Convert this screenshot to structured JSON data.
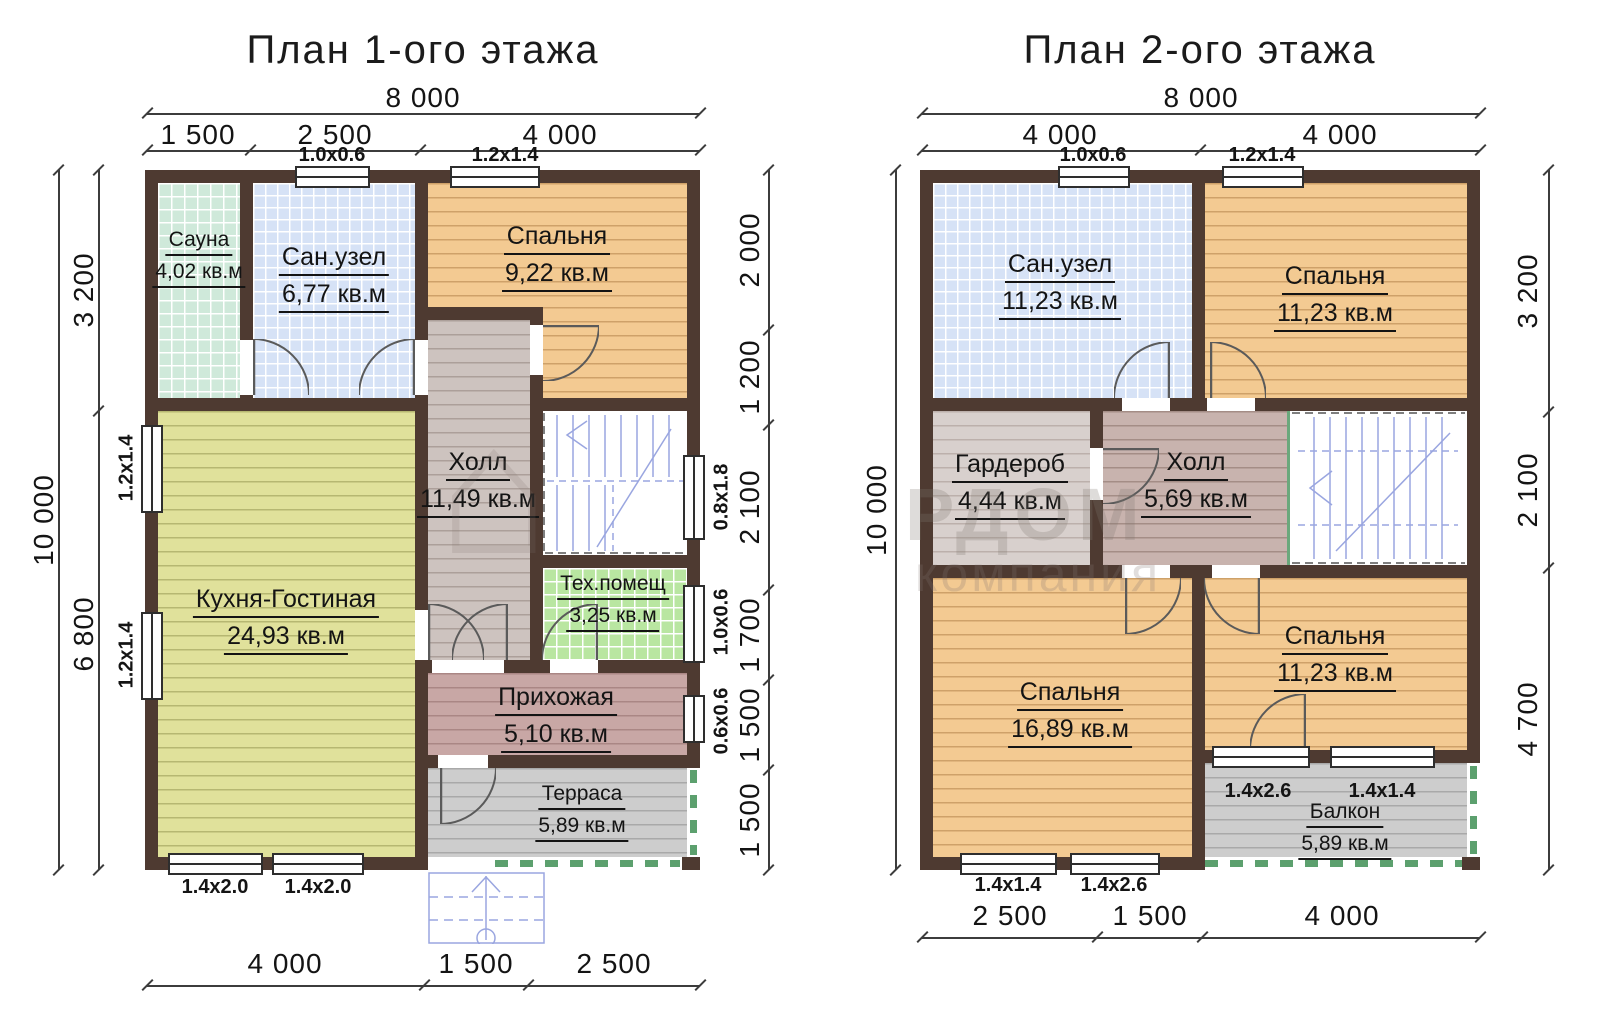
{
  "watermark": {
    "icon": "house-logo",
    "brand": "РДОМ",
    "subtitle": "компания"
  },
  "plans": [
    {
      "title": "План 1-ого этажа",
      "dims": {
        "top_total": "8 000",
        "top": [
          "1 500",
          "2 500",
          "4 000"
        ],
        "left_total": "10 000",
        "left": [
          "3 200",
          "6 800"
        ],
        "right": [
          "2 000",
          "1 200",
          "2 100",
          "1 700",
          "1 500",
          "1 500"
        ],
        "bottom": [
          "4 000",
          "1 500",
          "2 500"
        ]
      },
      "windows": {
        "top": [
          "1.0x0.6",
          "1.2x1.4"
        ],
        "left": [
          "1.2x1.4",
          "1.2x1.4"
        ],
        "right": [
          "0.8x1.8",
          "1.0x0.6",
          "0.6x0.6"
        ],
        "bottom": [
          "1.4x2.0",
          "1.4x2.0"
        ]
      },
      "rooms": [
        {
          "name": "Сауна",
          "area": "4,02 кв.м"
        },
        {
          "name": "Сан.узел",
          "area": "6,77 кв.м"
        },
        {
          "name": "Спальня",
          "area": "9,22 кв.м"
        },
        {
          "name": "Холл",
          "area": "11,49 кв.м"
        },
        {
          "name": "Кухня-Гостиная",
          "area": "24,93 кв.м"
        },
        {
          "name": "Тех.помещ",
          "area": "3,25 кв.м"
        },
        {
          "name": "Прихожая",
          "area": "5,10 кв.м"
        },
        {
          "name": "Терраса",
          "area": "5,89 кв.м"
        }
      ]
    },
    {
      "title": "План 2-ого этажа",
      "dims": {
        "top_total": "8 000",
        "top": [
          "4 000",
          "4 000"
        ],
        "left_total": "10 000",
        "right": [
          "3 200",
          "2 100",
          "4 700"
        ],
        "bottom": [
          "2 500",
          "1 500",
          "4 000"
        ]
      },
      "windows": {
        "top": [
          "1.0x0.6",
          "1.2x1.4"
        ],
        "balcony": [
          "1.4x2.6",
          "1.4x1.4"
        ],
        "bottom": [
          "1.4x1.4",
          "1.4x2.6"
        ]
      },
      "rooms": [
        {
          "name": "Сан.узел",
          "area": "11,23 кв.м"
        },
        {
          "name": "Спальня",
          "area": "11,23 кв.м"
        },
        {
          "name": "Гардероб",
          "area": "4,44 кв.м"
        },
        {
          "name": "Холл",
          "area": "5,69 кв.м"
        },
        {
          "name": "Спальня",
          "area": "16,89 кв.м"
        },
        {
          "name": "Спальня",
          "area": "11,23 кв.м"
        },
        {
          "name": "Балкон",
          "area": "5,89 кв.м"
        }
      ]
    }
  ],
  "colors": {
    "wall": "#4e3a31",
    "sauna_tile": "#cfe9da",
    "bath_tile": "#d6e2f6",
    "bedroom_floor": "#f3ca92",
    "kitchen_floor": "#e0e19b",
    "hall_floor": "#cdc3bf",
    "tech_tile": "#b9e6a1",
    "hallway_floor": "#c8a7a5",
    "terrace_floor": "#cdcdcd",
    "stairs_lines": "#9aa6e0",
    "railing": "#5ca06e"
  }
}
